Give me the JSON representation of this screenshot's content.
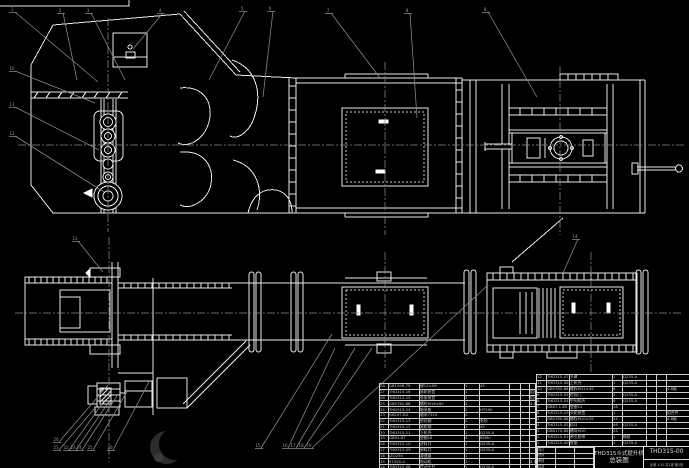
{
  "drawing": {
    "title_line1": "THD315斗式提升机",
    "title_line2": "总装图",
    "drawing_number": "THD315-00",
    "scale_note": "比例 1:10  共1张 第1张",
    "signature_rows": [
      [
        "设计",
        "",
        ""
      ],
      [
        "校核",
        "",
        ""
      ],
      [
        "审核",
        "",
        ""
      ],
      [
        "批准",
        "",
        ""
      ]
    ]
  },
  "parts_list_right": {
    "headers": [
      "序号",
      "代 号",
      "名 称",
      "数量",
      "材 料",
      "单重",
      "总重",
      "备注"
    ],
    "rows": [
      [
        "12",
        "THD315-07",
        "头罩",
        "1",
        "Q235-A",
        "",
        "",
        ""
      ],
      [
        "11",
        "THD315-06",
        "上机壳",
        "1",
        "Q235-A",
        "",
        "",
        ""
      ],
      [
        "10",
        "GB5782-86",
        "螺栓M12×45",
        "8",
        "",
        "",
        "",
        "4.8级"
      ],
      [
        "9",
        "THD315-05",
        "检视门",
        "2",
        "Q235-A",
        "",
        "",
        ""
      ],
      [
        "8",
        "THD315-04",
        "中间机壳",
        "6",
        "Q235-A",
        "",
        "",
        ""
      ],
      [
        "7",
        "GB97.1-85",
        "垫圈12",
        "16",
        "",
        "",
        "",
        ""
      ],
      [
        "6",
        "THD315-03",
        "头轮装置",
        "1",
        "",
        "",
        "",
        "组合件"
      ],
      [
        "5",
        "GB5780-86",
        "螺栓M10×35",
        "24",
        "",
        "",
        "",
        "4.8级"
      ],
      [
        "4",
        "THD315-02",
        "料斗",
        "46",
        "Q235-A",
        "",
        "",
        ""
      ],
      [
        "3",
        "GB6170-86",
        "螺母M10",
        "24",
        "",
        "",
        "",
        ""
      ],
      [
        "2",
        "THD315-01",
        "牵引胶带",
        "1",
        "橡胶",
        "",
        "",
        ""
      ],
      [
        "1",
        "THD315-00-01",
        "底座",
        "1",
        "Q235-A",
        "",
        "",
        ""
      ]
    ]
  },
  "parts_list_left": {
    "rows": [
      [
        "28",
        "GB1096-79",
        "键12×56",
        "1",
        "45",
        "",
        "",
        ""
      ],
      [
        "27",
        "THD315-16",
        "尾轮装置",
        "1",
        "",
        "",
        "",
        "组合件"
      ],
      [
        "26",
        "THD315-15",
        "张紧装置",
        "2",
        "",
        "",
        "",
        "组合件"
      ],
      [
        "25",
        "GB5782-86",
        "螺栓M16×60",
        "4",
        "",
        "",
        "",
        "4.8级"
      ],
      [
        "24",
        "THD315-14",
        "轴承座",
        "2",
        "HT200",
        "",
        "",
        ""
      ],
      [
        "23",
        "GB297-84",
        "轴承7310",
        "2",
        "",
        "",
        "",
        ""
      ],
      [
        "22",
        "THD315-13",
        "密封圈",
        "2",
        "毛毡",
        "",
        "",
        ""
      ],
      [
        "21",
        "THD315-12",
        "尾轮轴",
        "1",
        "45",
        "",
        "",
        ""
      ],
      [
        "20",
        "THD315-11",
        "下机壳",
        "1",
        "Q235-A",
        "",
        "",
        ""
      ],
      [
        "19",
        "GB93-87",
        "垫圈16",
        "4",
        "65Mn",
        "",
        "",
        ""
      ],
      [
        "18",
        "THD315-10",
        "进料口",
        "1",
        "Q235-A",
        "",
        "",
        ""
      ],
      [
        "17",
        "THD315-09",
        "卸料口",
        "1",
        "Q235-A",
        "",
        "",
        ""
      ],
      [
        "16",
        "JZQ250",
        "减速器",
        "1",
        "",
        "",
        "",
        ""
      ],
      [
        "15",
        "Y132S-4",
        "电动机",
        "1",
        "",
        "",
        "",
        "5.5kW"
      ],
      [
        "14",
        "THD315-08",
        "传动平台",
        "1",
        "Q235-A",
        "",
        "",
        ""
      ],
      [
        "13",
        "GB5014-85",
        "弹性联轴器",
        "1",
        "",
        "",
        "",
        ""
      ]
    ]
  },
  "callouts": [
    {
      "label": "1",
      "x": 12,
      "y": 9,
      "tx": 98,
      "ty": 82
    },
    {
      "label": "2",
      "x": 60,
      "y": 10,
      "tx": 77,
      "ty": 80
    },
    {
      "label": "3",
      "x": 88,
      "y": 10,
      "tx": 125,
      "ty": 80
    },
    {
      "label": "4",
      "x": 160,
      "y": 10,
      "tx": 133,
      "ty": 49
    },
    {
      "label": "5",
      "x": 242,
      "y": 8,
      "tx": 209,
      "ty": 80
    },
    {
      "label": "6",
      "x": 270,
      "y": 8,
      "tx": 263,
      "ty": 97
    },
    {
      "label": "7",
      "x": 328,
      "y": 10,
      "tx": 380,
      "ty": 78
    },
    {
      "label": "8",
      "x": 407,
      "y": 10,
      "tx": 417,
      "ty": 118
    },
    {
      "label": "9",
      "x": 485,
      "y": 9,
      "tx": 537,
      "ty": 97
    },
    {
      "label": "10",
      "x": 12,
      "y": 68,
      "tx": 95,
      "ty": 103
    },
    {
      "label": "11",
      "x": 12,
      "y": 104,
      "tx": 99,
      "ty": 150
    },
    {
      "label": "12",
      "x": 12,
      "y": 133,
      "tx": 104,
      "ty": 192
    },
    {
      "label": "13",
      "x": 75,
      "y": 238,
      "tx": 103,
      "ty": 272
    },
    {
      "label": "14",
      "x": 575,
      "y": 236,
      "tx": 563,
      "ty": 273
    },
    {
      "label": "15",
      "x": 258,
      "y": 445,
      "tx": 332,
      "ty": 334
    },
    {
      "label": "16",
      "x": 285,
      "y": 445,
      "tx": 335,
      "ty": 348
    },
    {
      "label": "17",
      "x": 293,
      "y": 445,
      "tx": 355,
      "ty": 348
    },
    {
      "label": "18",
      "x": 301,
      "y": 445,
      "tx": 372,
      "ty": 348
    },
    {
      "label": "19",
      "x": 309,
      "y": 445,
      "tx": 488,
      "ty": 285
    },
    {
      "label": "20",
      "x": 56,
      "y": 439,
      "tx": 108,
      "ty": 385
    },
    {
      "label": "21",
      "x": 56,
      "y": 447,
      "tx": 95,
      "ty": 408
    },
    {
      "label": "22",
      "x": 66,
      "y": 447,
      "tx": 102,
      "ty": 404
    },
    {
      "label": "23",
      "x": 73,
      "y": 447,
      "tx": 110,
      "ty": 400
    },
    {
      "label": "24",
      "x": 79,
      "y": 447,
      "tx": 117,
      "ty": 396
    },
    {
      "label": "25",
      "x": 90,
      "y": 447,
      "tx": 128,
      "ty": 390
    },
    {
      "label": "26",
      "x": 110,
      "y": 447,
      "tx": 150,
      "ty": 380
    }
  ],
  "colors": {
    "background": "#000000",
    "line": "#e8e8e8",
    "leader": "#8c8c8c",
    "table_text": "#c8c8c8"
  }
}
